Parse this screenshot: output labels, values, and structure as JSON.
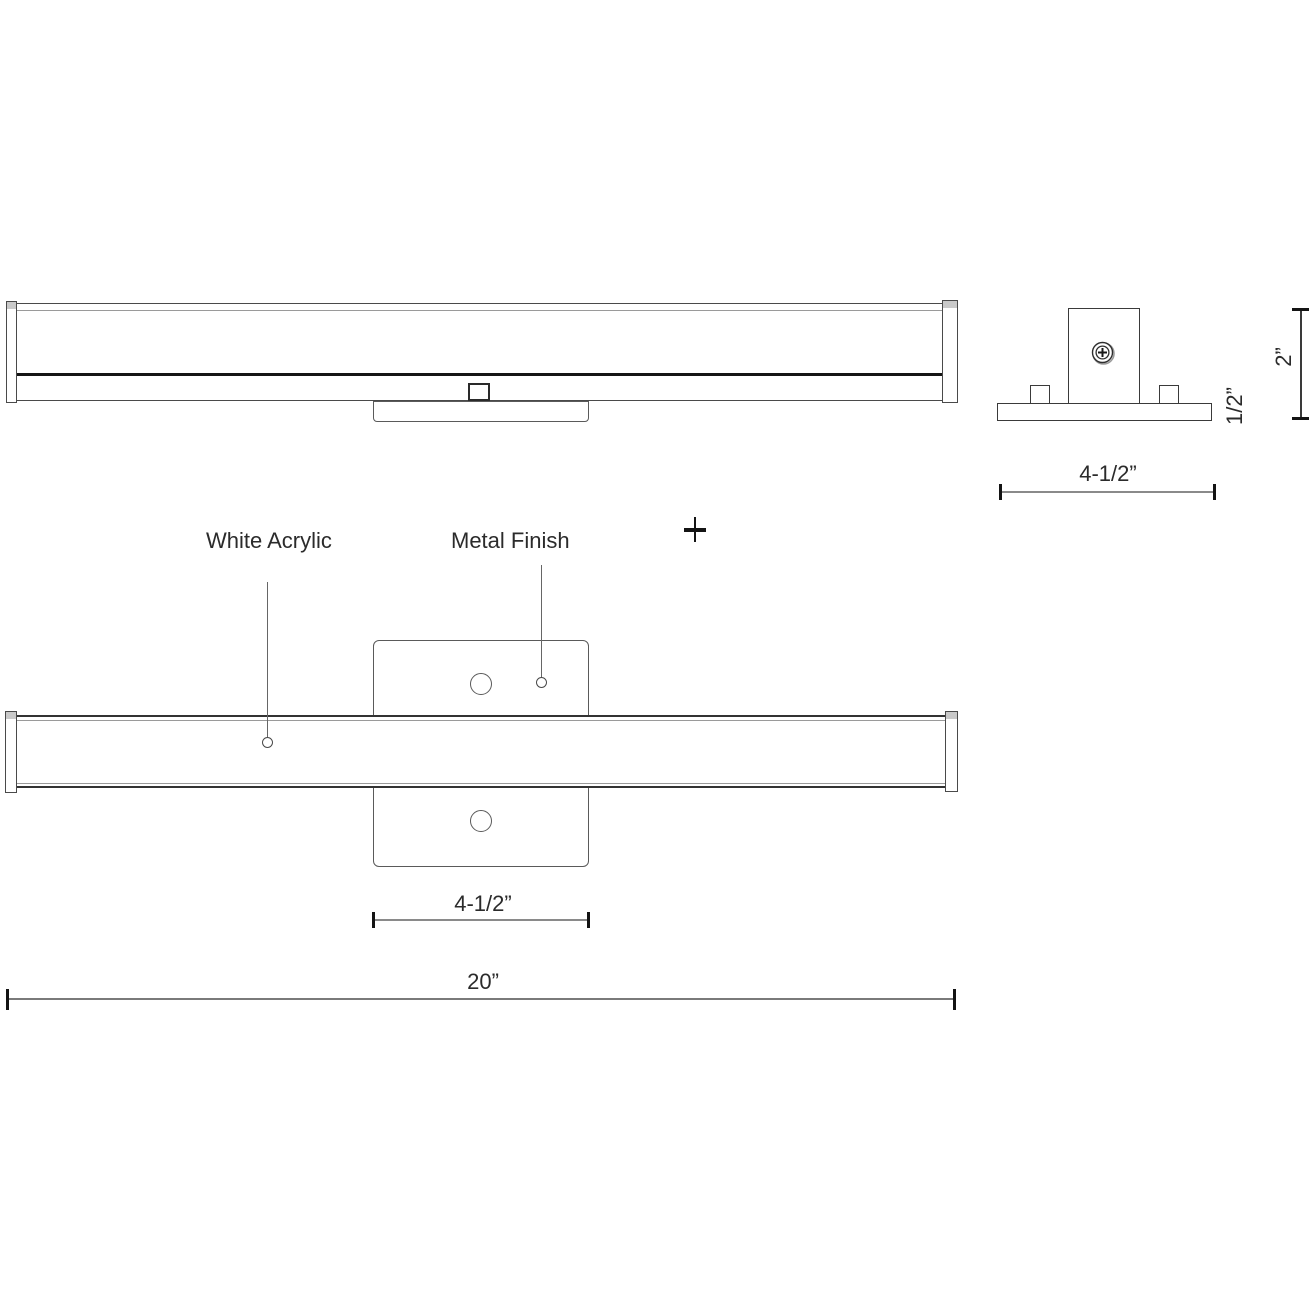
{
  "drawing": {
    "title": "vanity-light-dimension-drawing",
    "labels": {
      "white_acrylic": "White Acrylic",
      "metal_finish": "Metal Finish"
    },
    "dimensions": {
      "end_view_height": "2”",
      "end_view_plate_thickness": "1/2”",
      "end_view_plate_width": "4-1/2”",
      "front_plate_width": "4-1/2”",
      "overall_width": "20”"
    },
    "symbols": {
      "plus": "+"
    },
    "colors": {
      "background": "#ffffff",
      "outline_dark": "#1a1a1a",
      "outline_medium": "#4a4a4a",
      "dimension_line": "#8a8a8a",
      "cap_shade": "#c9c9c9"
    }
  }
}
